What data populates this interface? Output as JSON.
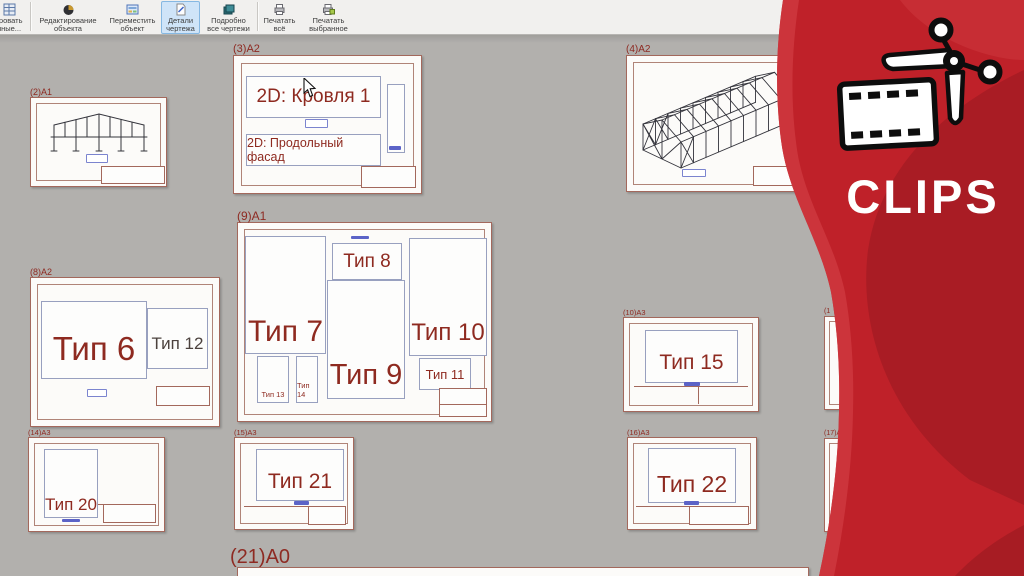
{
  "toolbar": {
    "buttons": [
      {
        "line1": "тровать",
        "line2": "нные..."
      },
      {
        "line1": "Редактирование",
        "line2": "объекта"
      },
      {
        "line1": "Переместить",
        "line2": "объект"
      },
      {
        "line1": "Детали",
        "line2": "чертежа"
      },
      {
        "line1": "Подробно",
        "line2": "все чертежи"
      },
      {
        "line1": "Печатать",
        "line2": "всё"
      },
      {
        "line1": "Печатать",
        "line2": "выбранное"
      }
    ]
  },
  "sheets": {
    "s2": {
      "label": "(2)A1"
    },
    "s3": {
      "label": "(3)A2",
      "view1": "2D: Кровля 1",
      "view2": "2D: Продольный фасад"
    },
    "s4": {
      "label": "(4)A2"
    },
    "s8": {
      "label": "(8)A2",
      "type6": "Тип 6",
      "type12": "Тип 12"
    },
    "s9": {
      "label": "(9)A1",
      "type7": "Тип 7",
      "type8": "Тип 8",
      "type9": "Тип 9",
      "type10": "Тип 10",
      "type11": "Тип 11",
      "type13": "Тип 13",
      "type14": "Тип 14"
    },
    "s10": {
      "label": "(10)A3",
      "type15": "Тип 15"
    },
    "s14": {
      "label": "(14)A3",
      "type20": "Тип 20"
    },
    "s15": {
      "label": "(15)A3",
      "type21": "Тип 21"
    },
    "s16": {
      "label": "(16)A3",
      "type22": "Тип 22"
    },
    "s21": {
      "label": "(21)A0"
    },
    "sr1": {
      "label": "(1"
    },
    "sr2": {
      "label": "(17)A"
    }
  },
  "watermark": {
    "text": "CLIPS"
  },
  "colors": {
    "banner_red": "#bf2129",
    "banner_dark": "#8f171e",
    "banner_light": "#cf3a40",
    "sheet_border": "#a3685c",
    "label_red": "#8e2a22",
    "type_red": "#8e2a20",
    "type_muted": "#4c423e",
    "view_border": "#98a0bf",
    "stamp_blue": "#5b63c7",
    "active_button_bg": "#cfe4f8",
    "canvas_gray": "#b2b0ad"
  }
}
